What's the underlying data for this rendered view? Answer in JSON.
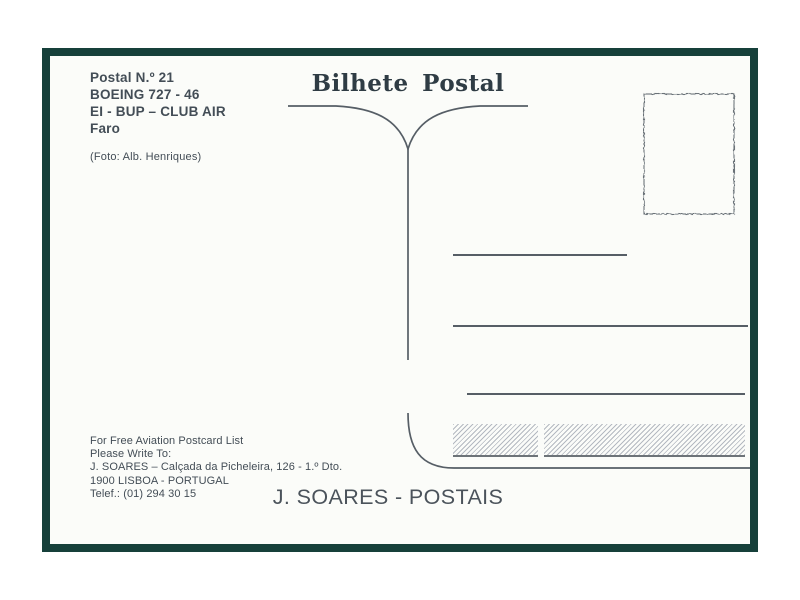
{
  "card": {
    "info": [
      "Postal N.º 21",
      "BOEING 727 - 46",
      "EI - BUP – CLUB AIR",
      "Faro"
    ],
    "photo_credit": "(Foto: Alb. Henriques)",
    "title": "Bilhete Postal",
    "publisher": [
      "For Free Aviation Postcard List",
      "Please Write To:",
      "J. SOARES – Calçada da Picheleira, 126 - 1.º Dto.",
      "1900 LISBOA - PORTUGAL",
      "Telef.: (01) 294 30 15"
    ],
    "footer": "J. SOARES - POSTAIS",
    "colors": {
      "frame": "#16403a",
      "ink": "#434d56",
      "line": "#565e66",
      "hatch": "#b4b9c1"
    }
  }
}
